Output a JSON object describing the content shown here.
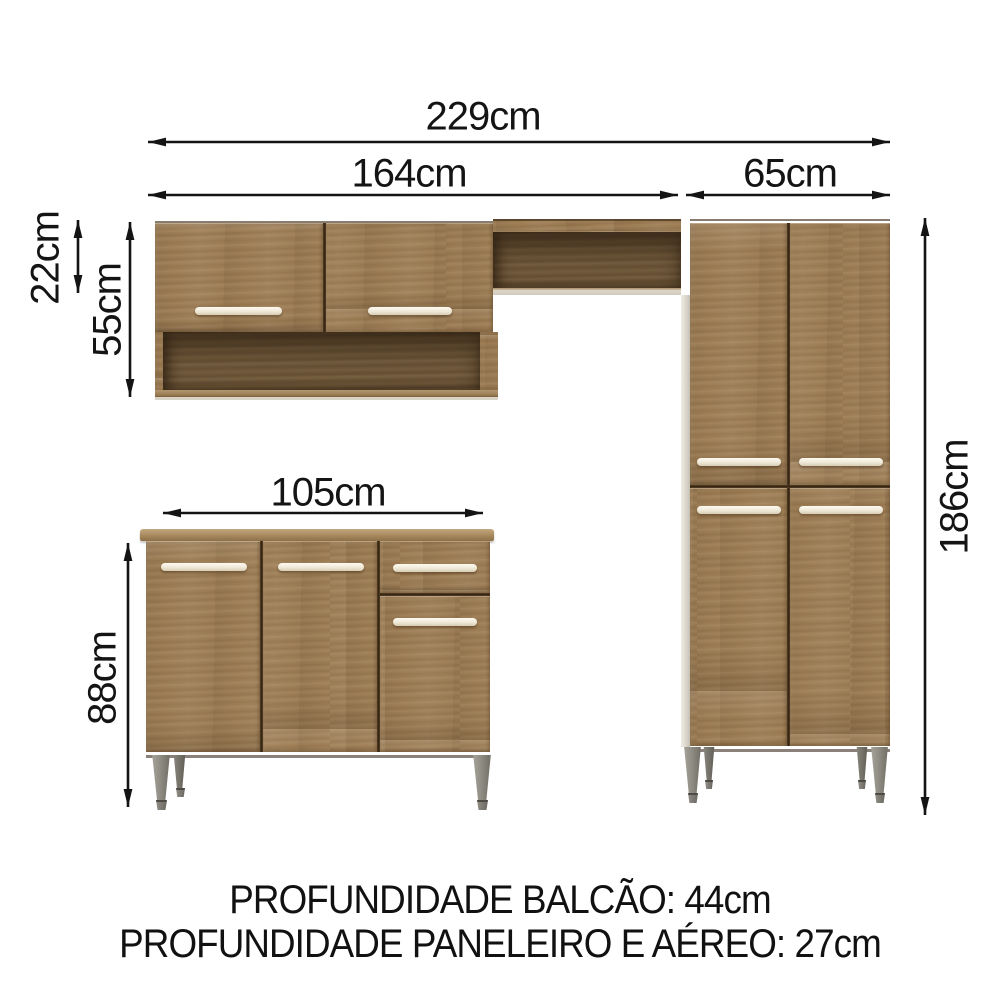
{
  "diagram": {
    "dimensions": {
      "total_width": "229cm",
      "upper_row_width": "164cm",
      "tall_cabinet_width": "65cm",
      "niche_height": "22cm",
      "wall_cabinet_height": "55cm",
      "base_cabinet_width": "105cm",
      "base_cabinet_height": "88cm",
      "tall_cabinet_height": "186cm"
    },
    "footer_notes": {
      "balcao_depth": "PROFUNDIDADE BALCÃO: 44cm",
      "paneleiro_aereo_depth": "PROFUNDIDADE PANELEIRO E AÉREO: 27cm"
    },
    "colors": {
      "wood": "#9b7b53",
      "wood_interior": "#6f5739",
      "counter_edge": "#b2976e",
      "handle": "#f5efe2",
      "legs": "#8f8d83",
      "dimension_lines": "#141414",
      "background": "#ffffff"
    }
  }
}
